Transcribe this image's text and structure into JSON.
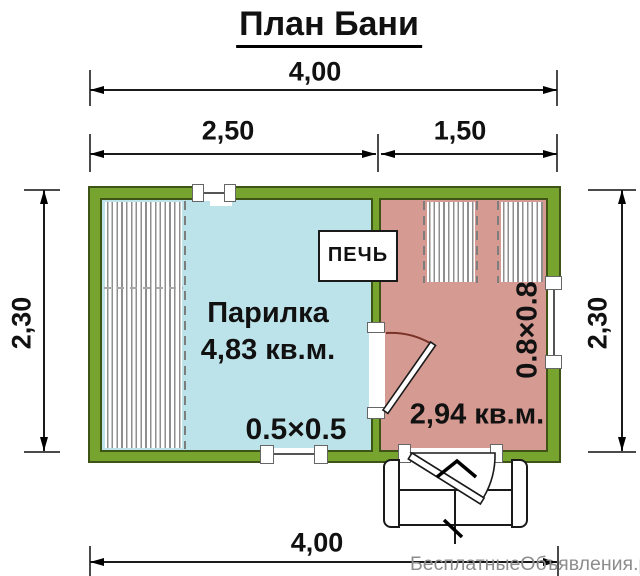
{
  "title": "План Бани",
  "dimensions": {
    "top_total": "4,00",
    "top_left": "2,50",
    "top_right": "1,50",
    "side_left": "2,30",
    "side_right": "2,30",
    "bottom_total": "4,00"
  },
  "rooms": {
    "steam": {
      "name": "Парилка",
      "area": "4,83 кв.м."
    },
    "rest": {
      "area": "2,94 кв.м."
    }
  },
  "labels": {
    "stove": "ПЕЧЬ",
    "window_small": "0.5×0.5",
    "window_large": "0.8×0.8"
  },
  "watermark": "БесплатныеОбъявления.рф",
  "colors": {
    "wall": "#77A42E",
    "wall_border": "#3E5316",
    "steam_room": "#BDE3EA",
    "rest_room": "#D59A92"
  }
}
